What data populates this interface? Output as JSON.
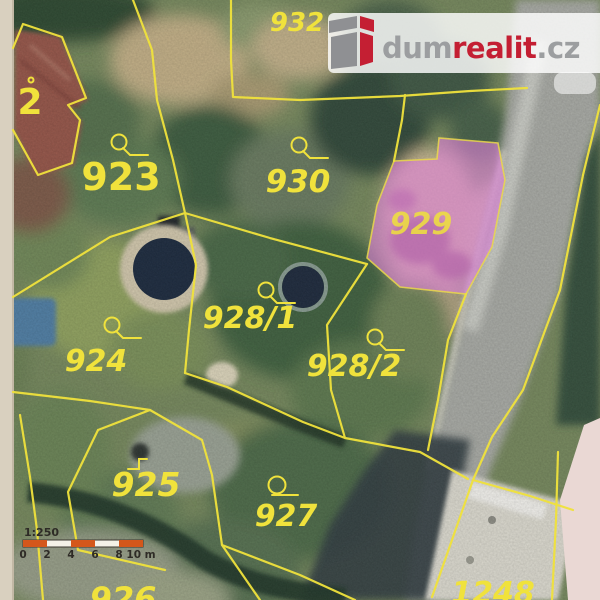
{
  "branding": {
    "dum": "dum",
    "realit": "realit",
    "cz": ".cz",
    "gray_color": "#9c9ea0",
    "red_color": "#c41f33"
  },
  "scale_bar": {
    "ratio": "1:250",
    "tick_labels": [
      "0",
      "2",
      "4",
      "6",
      "8",
      "10 m"
    ],
    "bar_color": "#d4571b"
  },
  "parcels": [
    {
      "label": "2"
    },
    {
      "label": "923"
    },
    {
      "label": "932"
    },
    {
      "label": "930"
    },
    {
      "label": "929",
      "highlighted": true
    },
    {
      "label": "928/1"
    },
    {
      "label": "928/2"
    },
    {
      "label": "924"
    },
    {
      "label": "925"
    },
    {
      "label": "927"
    },
    {
      "label": "926"
    },
    {
      "label": "1248"
    }
  ],
  "highlight": {
    "parcel": "929",
    "color": "#db7fd6"
  },
  "styles": {
    "boundary_color": "#f0e23c"
  },
  "icons": {
    "land_use_marker": "circle-with-tail",
    "building_use_marker": "step-mark"
  }
}
